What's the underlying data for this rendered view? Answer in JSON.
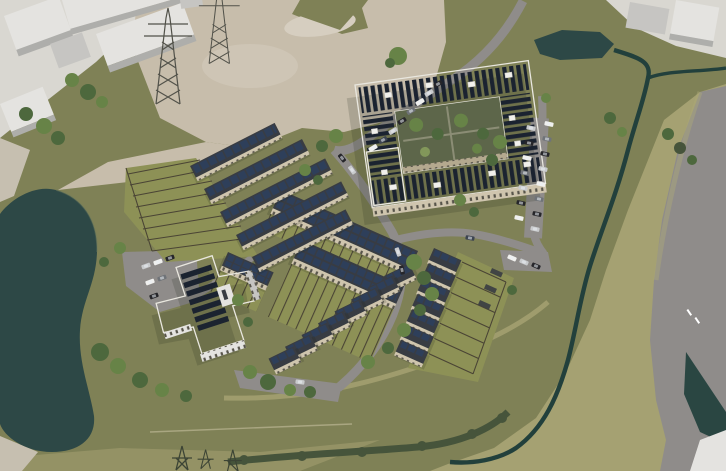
{
  "meta": {
    "domain": "architectural-aerial-render",
    "aria_label": "Aerial 3D visualisation of a proposed residential development with solar-panelled terraced houses, two green-roof apartment blocks, internal streets with parked cars, a pond, drainage ditches, electricity pylons and neighbouring industrial units",
    "description": "Bird's-eye massing render of a housing masterplan on a cleared site beside an existing industrial estate."
  },
  "palette": {
    "grass": "#7f8156",
    "grass2": "#a5a172",
    "garden": "#8d9156",
    "dirt": "#c7bdab",
    "dirt2": "#d6cec0",
    "apron": "#d9d7d1",
    "path": "#c6bfb0",
    "pond": "#2d4846",
    "stream": "#22403c",
    "road": "#8f8c8a",
    "khaki": "#aca878",
    "white1": "#e4e3e0",
    "white2": "#c6c5c2",
    "whiteside": "#aeaeab",
    "facade": "#cfc5ae",
    "facadeshade": "#b4a98f",
    "roofdark": "#383c43",
    "solar": "#1b2330",
    "solarcell": "#2e3f5a",
    "greenroof": "#7a7e50",
    "courtyard": "#5d664a",
    "tree1": "#4d683d",
    "tree2": "#678347",
    "tree3": "#82975a",
    "fence": "#4a4435",
    "hedge": "#46543b",
    "car_k": "#26262a",
    "car_s": "#c9cbcd",
    "car_w": "#f0f0ee",
    "car_g": "#6f7378",
    "car_d": "#3d4450"
  },
  "scene": {
    "ground": {
      "grass": "olive amenity grassland over most of the site",
      "grass_east": "lighter rough grassland east of the ditch and along the south",
      "cleared_dirt": "bare earth construction area to the north",
      "paths": "pale footpaths at the west edge"
    },
    "water": {
      "pond": "large irregular attenuation pond on the west boundary",
      "upper_pond": "small pond north-east of the site",
      "stream": "drainage ditch winding along the east and south-east boundary"
    },
    "buildings": {
      "courtyard_block": "large U/ring-shaped apartment block, sedum green roof with rows of PV solar panels and rooflights, planted internal courtyard",
      "cross_block": "smaller cross-plan apartment block with green roof and PV arrays, white facades",
      "terrace_rows_nw": "five terraced rows with solar roofs and fenced garden plots fanning west",
      "terrace_rows_center": "two long three-storey terraces plus a short row, solar roofs, striped rear gardens",
      "house_chain_south": "staggered chain of eight solar-roofed houses stepping south-west",
      "house_chain_east": "staggered chain of seven solar-roofed houses with long garden fences to the east",
      "industrial_nw": "existing white warehouse units off-site to the north-west",
      "industrial_ne": "existing white units off-site to the north-east",
      "building_se": "corner of an off-site white building at the south-east"
    },
    "infrastructure": {
      "pylons": "two steel lattice electricity pylons on the northern dirt area and small masts at the southern edge",
      "streets": "looping internal access streets with hammerhead turning heads",
      "parking": "on-street parking, an eastern parking strip and a parking court by the cross block",
      "east_road": "existing highway with white lane markings along the east boundary",
      "cars": "around thirty parked and moving cars in white, silver, grey and black"
    },
    "vegetation": {
      "trees": "street trees, courtyard planting and boundary tree belts",
      "gardens": "rear garden strips divided by dark timber fences",
      "hedgerow": "dark hedgerow along the southern site boundary"
    }
  }
}
